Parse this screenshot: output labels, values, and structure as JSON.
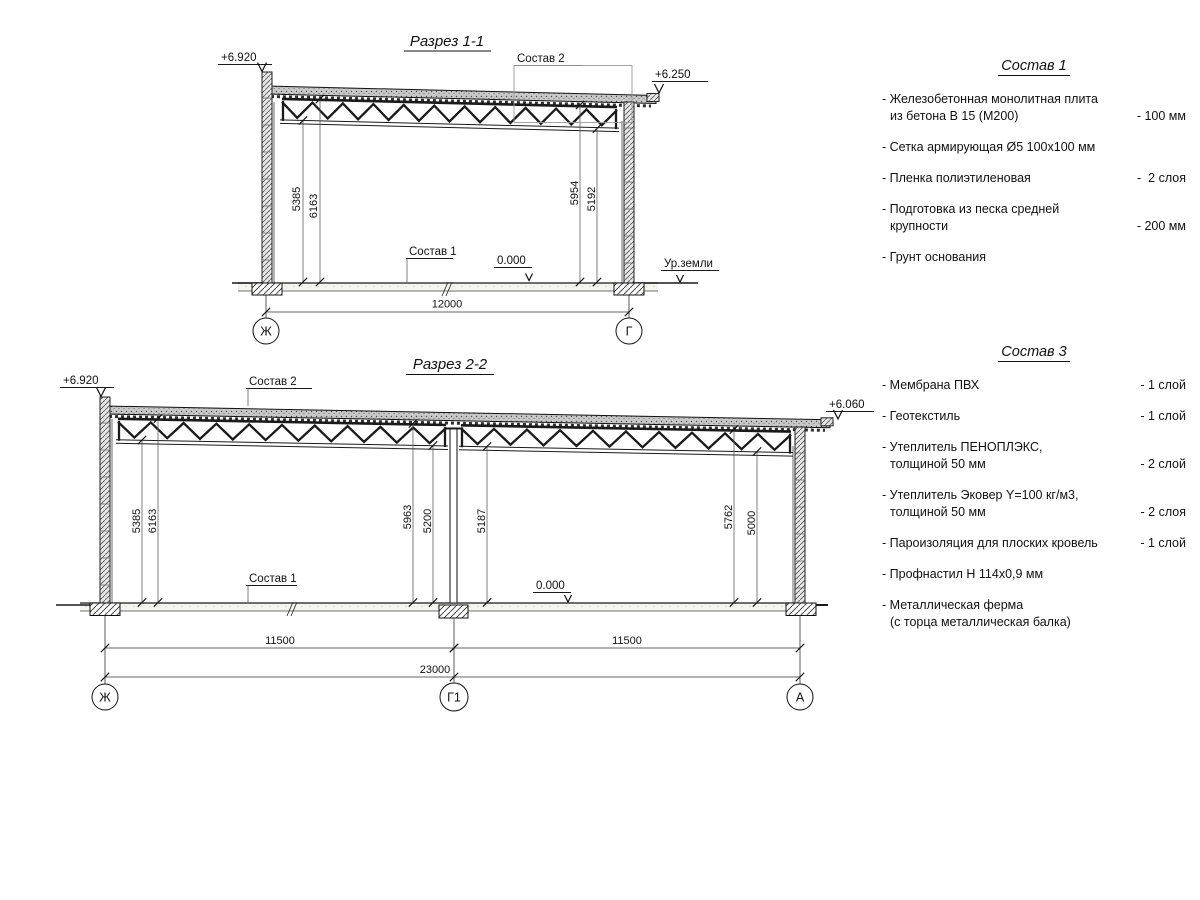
{
  "section1": {
    "title": "Разрез 1-1",
    "level_left": "+6.920",
    "level_right": "+6.250",
    "callout_sostav2": "Состав 2",
    "callout_sostav1": "Состав 1",
    "zero_level": "0.000",
    "ground_label": "Ур.земли",
    "dim_left_1": "5385",
    "dim_left_2": "6163",
    "dim_right_1": "5954",
    "dim_right_2": "5192",
    "dim_span": "12000",
    "axis_left": "Ж",
    "axis_right": "Г"
  },
  "section2": {
    "title": "Разрез 2-2",
    "level_left": "+6.920",
    "level_right": "+6.060",
    "callout_sostav2": "Состав 2",
    "callout_sostav1": "Состав 1",
    "zero_level": "0.000",
    "dim_left_1": "5385",
    "dim_left_2": "6163",
    "dim_mid_1": "5963",
    "dim_mid_2": "5200",
    "dim_mid_3": "5187",
    "dim_right_1": "5762",
    "dim_right_2": "5000",
    "dim_bay_1": "11500",
    "dim_bay_2": "11500",
    "dim_total": "23000",
    "axis_left": "Ж",
    "axis_mid": "Г1",
    "axis_right": "А"
  },
  "sostav1": {
    "title": "Состав 1",
    "items": [
      {
        "line1": "- Железобетонная  монолитная плита",
        "line2": "из бетона В 15 (М200)",
        "value": "- 100 мм"
      },
      {
        "line1": "- Сетка армирующая Ø5 100х100 мм",
        "line2": "",
        "value": ""
      },
      {
        "line1": "- Пленка полиэтиленовая",
        "line2": "",
        "value": "-  2 слоя"
      },
      {
        "line1": "- Подготовка из песка средней",
        "line2": "крупности",
        "value": "- 200 мм"
      },
      {
        "line1": "- Грунт основания",
        "line2": "",
        "value": ""
      }
    ]
  },
  "sostav3": {
    "title": "Состав 3",
    "items": [
      {
        "line1": "- Мембрана ПВХ",
        "line2": "",
        "value": "- 1 слой"
      },
      {
        "line1": "- Геотекстиль",
        "line2": "",
        "value": "- 1 слой"
      },
      {
        "line1": "- Утеплитель ПЕНОПЛЭКС,",
        "line2": "толщиной 50 мм",
        "value": "- 2 слой"
      },
      {
        "line1": "- Утеплитель Эковер Y=100 кг/м3,",
        "line2": "толщиной 50 мм",
        "value": "- 2 слоя"
      },
      {
        "line1": "- Пароизоляция для плоских кровель",
        "line2": "",
        "value": "- 1 слой"
      },
      {
        "line1": "- Профнастил Н 114х0,9 мм",
        "line2": "",
        "value": ""
      },
      {
        "line1": "- Металлическая ферма",
        "line2": "(с торца металлическая балка)",
        "value": ""
      }
    ]
  }
}
